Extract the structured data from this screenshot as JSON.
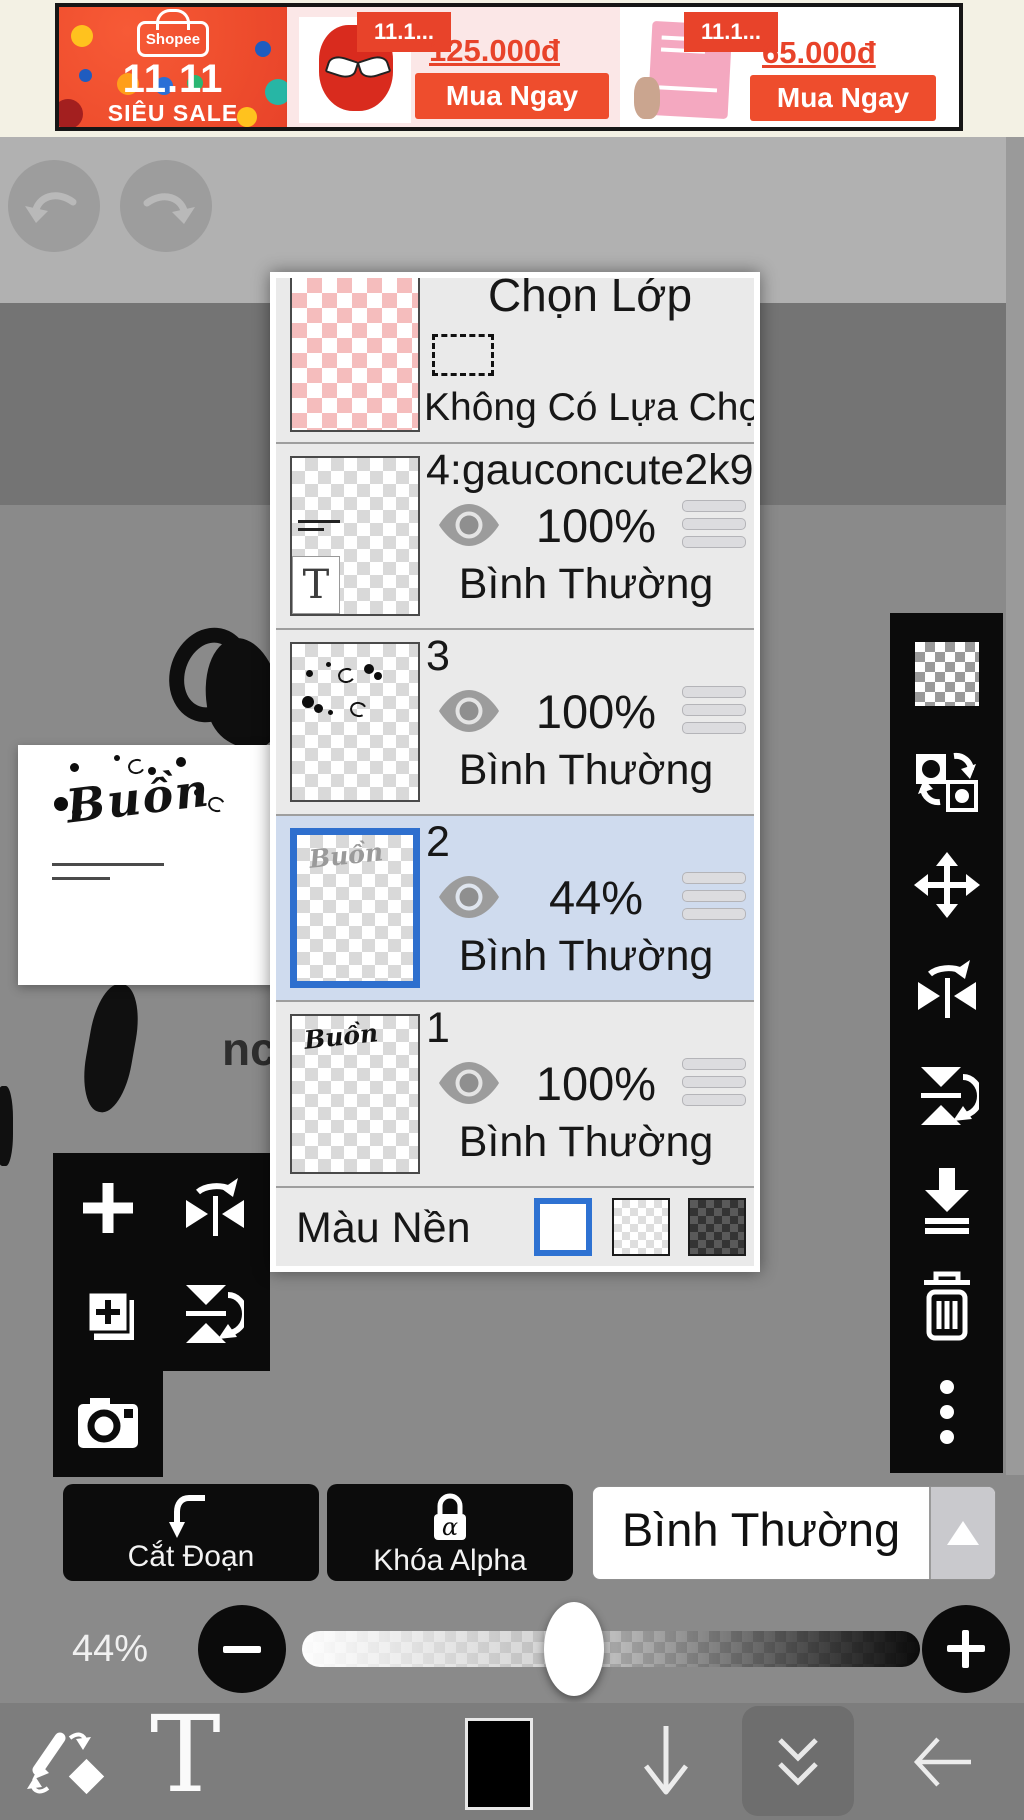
{
  "ad": {
    "brand": "Shopee",
    "event": "11.11",
    "tagline": "SIÊU SALE",
    "products": [
      {
        "badge": "11.1...",
        "price": "125.000đ",
        "cta": "Mua Ngay"
      },
      {
        "badge": "11.1...",
        "price": "65.000đ",
        "cta": "Mua Ngay"
      }
    ]
  },
  "layers_panel": {
    "title": "Chọn Lớp",
    "selection_status": "Không Có Lựa Chọn",
    "layers": [
      {
        "name": "4:gauconcute2k9",
        "opacity": "100%",
        "blend": "Bình Thường",
        "selected": false,
        "type_badge": "T"
      },
      {
        "name": "3",
        "opacity": "100%",
        "blend": "Bình Thường",
        "selected": false
      },
      {
        "name": "2",
        "opacity": "44%",
        "blend": "Bình Thường",
        "selected": true
      },
      {
        "name": "1",
        "opacity": "100%",
        "blend": "Bình Thường",
        "selected": false
      }
    ],
    "background_label": "Màu Nền"
  },
  "right_toolbar": {
    "icons": [
      "transparency-checker",
      "convert-layer",
      "move-layer",
      "flip-horizontal",
      "flip-vertical",
      "merge-down",
      "delete-layer",
      "more-options"
    ]
  },
  "left_toolbar": {
    "icons": [
      "add-layer",
      "flip-horizontal",
      "duplicate-layer",
      "flip-vertical",
      "import-camera"
    ]
  },
  "footer": {
    "clip_label": "Cắt Đoạn",
    "alpha_lock_label": "Khóa Alpha",
    "alpha_glyph": "α",
    "blend_mode": "Bình Thường",
    "opacity": "44%"
  },
  "toolbar": {
    "text_tool": "T"
  },
  "canvas": {
    "artwork_word": "Buồn",
    "stray_text": "nc"
  },
  "colors": {
    "accent_blue": "#2e6fce",
    "shopee_orange": "#ee4d2d",
    "selected_row": "#cfdbee"
  }
}
